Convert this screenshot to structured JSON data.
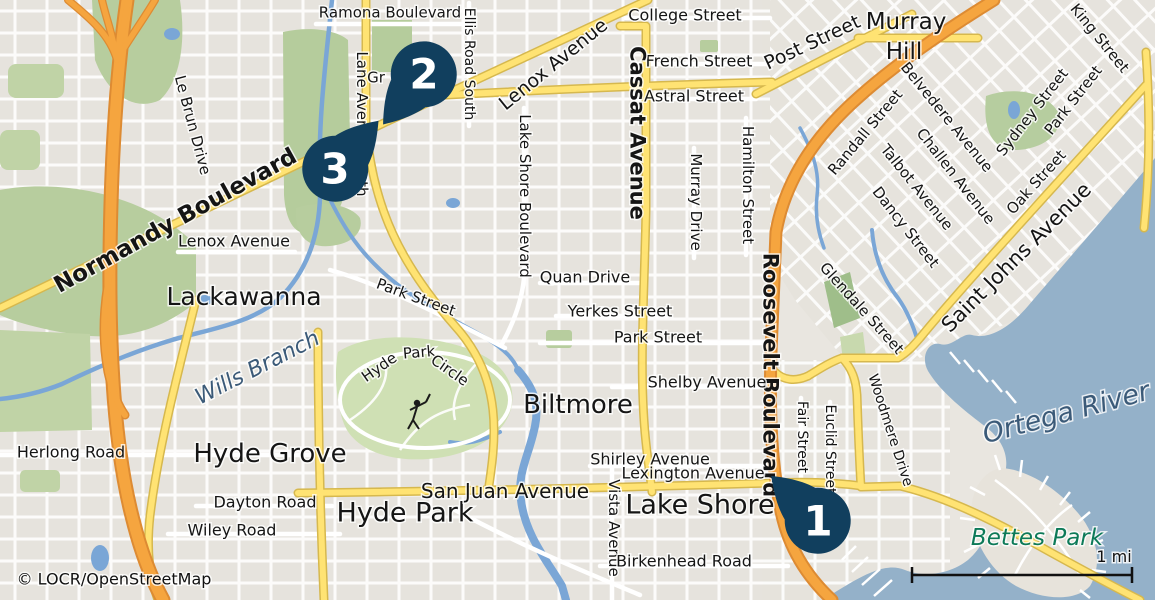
{
  "map": {
    "attribution": "© LOCR/OpenStreetMap",
    "scale": {
      "label": "1 mi"
    },
    "colors": {
      "land": "#e9e6e0",
      "water": "#94b1c9",
      "stream": "#7aa6d6",
      "green": "#b7cd9e",
      "green_dark": "#9fbe8a",
      "golf": "#cfe0b4",
      "road_yellow": "#ffe373",
      "road_yellow_casing": "#d6b84e",
      "road_orange": "#f5a53f",
      "road_orange_casing": "#dd8b33",
      "marker": "#113f5e",
      "marker_number": "#ffffff",
      "street_label": "#151515",
      "water_label": "#3b5a78",
      "park_label": "#0d7a58"
    },
    "markers": [
      {
        "number": "1",
        "cx": 818,
        "cy": 521,
        "tail_angle": -136
      },
      {
        "number": "2",
        "cx": 424,
        "cy": 74,
        "tail_angle": 129
      },
      {
        "number": "3",
        "cx": 335,
        "cy": 169,
        "tail_angle": -48
      }
    ],
    "labels": [
      {
        "text": "Ramona Boulevard",
        "x": 390,
        "y": 12,
        "rot": 0,
        "size": 15
      },
      {
        "text": "Lane Avenue South",
        "x": 362,
        "y": 124,
        "rot": 90,
        "size": 15
      },
      {
        "text": "Ellis Road South",
        "x": 470,
        "y": 64,
        "rot": 90,
        "size": 14
      },
      {
        "text": "Lenox Avenue",
        "x": 553,
        "y": 64,
        "rot": -39,
        "size": 19
      },
      {
        "text": "College Street",
        "x": 685,
        "y": 15,
        "rot": 0,
        "size": 16
      },
      {
        "text": "French Street",
        "x": 699,
        "y": 61,
        "rot": 0,
        "size": 16
      },
      {
        "text": "Astral Street",
        "x": 694,
        "y": 96,
        "rot": 0,
        "size": 16
      },
      {
        "text": "Post Street",
        "x": 812,
        "y": 42,
        "rot": -25,
        "size": 19
      },
      {
        "text": "Murray",
        "x": 906,
        "y": 21,
        "rot": 0,
        "size": 23
      },
      {
        "text": "Hill",
        "x": 904,
        "y": 51,
        "rot": 0,
        "size": 23
      },
      {
        "text": "King Street",
        "x": 1100,
        "y": 38,
        "rot": 51,
        "size": 15
      },
      {
        "text": "Park Street",
        "x": 1073,
        "y": 100,
        "rot": -52,
        "size": 15
      },
      {
        "text": "Sydney Street",
        "x": 1032,
        "y": 112,
        "rot": -52,
        "size": 15
      },
      {
        "text": "Belvedere Avenue",
        "x": 947,
        "y": 117,
        "rot": 51,
        "size": 15
      },
      {
        "text": "Randall Street",
        "x": 865,
        "y": 132,
        "rot": -50,
        "size": 15
      },
      {
        "text": "Challen Avenue",
        "x": 956,
        "y": 176,
        "rot": 52,
        "size": 15
      },
      {
        "text": "Talbot Avenue",
        "x": 917,
        "y": 187,
        "rot": 51,
        "size": 15
      },
      {
        "text": "Oak Street",
        "x": 1036,
        "y": 182,
        "rot": -48,
        "size": 15
      },
      {
        "text": "Dancy Street",
        "x": 906,
        "y": 227,
        "rot": 52,
        "size": 15
      },
      {
        "text": "Saint Johns Avenue",
        "x": 1016,
        "y": 257,
        "rot": -45,
        "size": 21
      },
      {
        "text": "Normandy Boulevard",
        "x": 175,
        "y": 220,
        "rot": -29,
        "size": 23,
        "bold": true
      },
      {
        "text": "Le Brun Drive",
        "x": 193,
        "y": 125,
        "rot": 75,
        "size": 15
      },
      {
        "text": "Gr",
        "x": 376,
        "y": 77,
        "rot": 0,
        "size": 15
      },
      {
        "text": "Lenox Avenue",
        "x": 234,
        "y": 241,
        "rot": 0,
        "size": 16
      },
      {
        "text": "Lackawanna",
        "x": 244,
        "y": 296,
        "rot": 0,
        "size": 25
      },
      {
        "text": "Cassat Avenue",
        "x": 638,
        "y": 133,
        "rot": 90,
        "size": 21,
        "bold": true
      },
      {
        "text": "Hamilton Street",
        "x": 748,
        "y": 185,
        "rot": 90,
        "size": 15
      },
      {
        "text": "Murray Drive",
        "x": 696,
        "y": 202,
        "rot": 90,
        "size": 15
      },
      {
        "text": "Roosevelt Boulevard",
        "x": 771,
        "y": 375,
        "rot": 90,
        "size": 21,
        "bold": true
      },
      {
        "text": "Glendale Street",
        "x": 862,
        "y": 308,
        "rot": 48,
        "size": 15
      },
      {
        "text": "Lake Shore Boulevard",
        "x": 525,
        "y": 196,
        "rot": 90,
        "size": 15
      },
      {
        "text": "Quan Drive",
        "x": 585,
        "y": 277,
        "rot": 0,
        "size": 16
      },
      {
        "text": "Yerkes Street",
        "x": 620,
        "y": 311,
        "rot": 0,
        "size": 16
      },
      {
        "text": "Park Street",
        "x": 658,
        "y": 337,
        "rot": 0,
        "size": 16
      },
      {
        "text": "Shelby Avenue",
        "x": 707,
        "y": 382,
        "rot": 0,
        "size": 16
      },
      {
        "text": "Park Street",
        "x": 416,
        "y": 297,
        "rot": 20,
        "size": 15
      },
      {
        "text": "Wills Branch",
        "x": 257,
        "y": 367,
        "rot": -27,
        "size": 22,
        "italic": true,
        "color": "#3b5a78"
      },
      {
        "text": "Hyde",
        "x": 379,
        "y": 367,
        "rot": -35,
        "size": 15
      },
      {
        "text": "Park",
        "x": 419,
        "y": 352,
        "rot": -5,
        "size": 15
      },
      {
        "text": "Circle",
        "x": 450,
        "y": 370,
        "rot": 35,
        "size": 15
      },
      {
        "text": "Biltmore",
        "x": 578,
        "y": 404,
        "rot": 0,
        "size": 26
      },
      {
        "text": "Herlong Road",
        "x": 71,
        "y": 452,
        "rot": 0,
        "size": 16
      },
      {
        "text": "Hyde Grove",
        "x": 270,
        "y": 453,
        "rot": 0,
        "size": 26
      },
      {
        "text": "Dayton Road",
        "x": 265,
        "y": 502,
        "rot": 0,
        "size": 16
      },
      {
        "text": "Wiley Road",
        "x": 232,
        "y": 530,
        "rot": 0,
        "size": 16
      },
      {
        "text": "Hyde Park",
        "x": 405,
        "y": 512,
        "rot": 0,
        "size": 27
      },
      {
        "text": "San Juan Avenue",
        "x": 505,
        "y": 491,
        "rot": 0,
        "size": 20
      },
      {
        "text": "Shirley Avenue",
        "x": 650,
        "y": 459,
        "rot": 0,
        "size": 16
      },
      {
        "text": "Lexington Avenue",
        "x": 693,
        "y": 473,
        "rot": 0,
        "size": 16
      },
      {
        "text": "Lake Shore",
        "x": 700,
        "y": 504,
        "rot": 0,
        "size": 27
      },
      {
        "text": "Vista Avenue",
        "x": 614,
        "y": 528,
        "rot": 90,
        "size": 15
      },
      {
        "text": "Birkenhead Road",
        "x": 684,
        "y": 561,
        "rot": 0,
        "size": 16
      },
      {
        "text": "Fair Street",
        "x": 803,
        "y": 437,
        "rot": 90,
        "size": 14
      },
      {
        "text": "Euclid Street",
        "x": 831,
        "y": 449,
        "rot": 90,
        "size": 14
      },
      {
        "text": "Woodmere Drive",
        "x": 891,
        "y": 430,
        "rot": 72,
        "size": 14
      },
      {
        "text": "Ortega River",
        "x": 1066,
        "y": 412,
        "rot": -15,
        "size": 27,
        "italic": true,
        "color": "#3b5a78"
      },
      {
        "text": "Bettes Park",
        "x": 1037,
        "y": 537,
        "rot": 0,
        "size": 23,
        "italic": true,
        "color": "#0d7a58"
      },
      {
        "text": "© LOCR/OpenStreetMap",
        "x": 114,
        "y": 579,
        "rot": 0,
        "size": 16,
        "color": "#111111"
      }
    ]
  }
}
